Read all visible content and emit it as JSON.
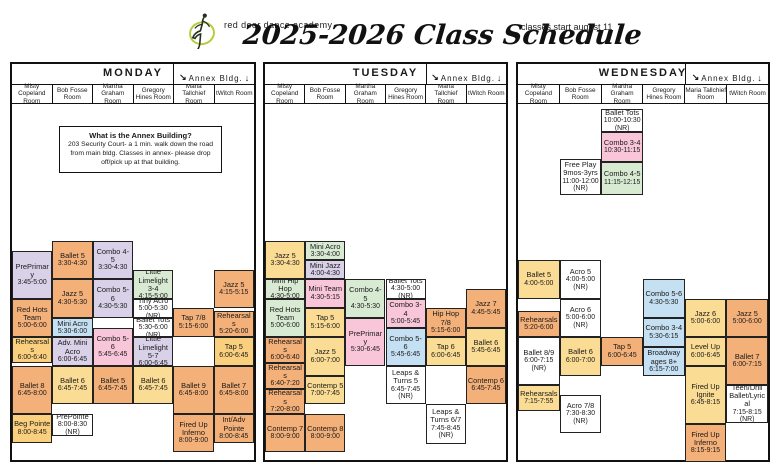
{
  "header": {
    "studio_name": "red door dance academy",
    "title": "2025-2026 Class Schedule",
    "start_note": "classes start august 11"
  },
  "annex": {
    "label": "Annex Bldg.",
    "arrow_left": "↘",
    "arrow_right": "↓"
  },
  "annex_info": {
    "title": "What is the Annex Building?",
    "body": "203 Security Court- a 1 min. walk down the road from main bldg. Classes in annex- please drop off/pick up at that building."
  },
  "rooms": [
    "Misty Copeland Room",
    "Bob Fosse Room",
    "Martha Graham Room",
    "Gregory Hines Room",
    "Maria Tallchief Room",
    "tWitch Room"
  ],
  "colors": {
    "orange": "#F4B079",
    "yellow": "#FBDC94",
    "gold": "#FAD07E",
    "lavender": "#D8D1E8",
    "green": "#D8EAD2",
    "pink": "#F8C6D8",
    "blue": "#C5E0F2",
    "white": "#FFFFFF"
  },
  "days": [
    {
      "name": "MONDAY",
      "classes": [
        {
          "room": 0,
          "name": "PrePrimary",
          "time": "3:45-5:00",
          "color": "lavender",
          "top": 147,
          "h": 48
        },
        {
          "room": 0,
          "name": "Red Hots Team",
          "time": "5:00-6:00",
          "color": "orange",
          "top": 195,
          "h": 38
        },
        {
          "room": 0,
          "name": "Rehearsals",
          "time": "6:00-6:40",
          "color": "gold",
          "top": 233,
          "h": 26
        },
        {
          "room": 0,
          "name": "Ballet 8",
          "time": "6:45-8:00",
          "color": "orange",
          "top": 262,
          "h": 48
        },
        {
          "room": 0,
          "name": "Beg Pointe",
          "time": "8:00-8:45",
          "color": "gold",
          "top": 310,
          "h": 29
        },
        {
          "room": 1,
          "name": "Ballet 5",
          "time": "3:30-4:30",
          "color": "orange",
          "top": 137,
          "h": 38
        },
        {
          "room": 1,
          "name": "Jazz 5",
          "time": "4:30-5:30",
          "color": "orange",
          "top": 175,
          "h": 39
        },
        {
          "room": 1,
          "name": "Mini Acro",
          "time": "5:30-6:00",
          "color": "blue",
          "top": 214,
          "h": 19
        },
        {
          "room": 1,
          "name": "Adv. Mini Acro",
          "time": "6:00-6:45",
          "color": "lavender",
          "top": 233,
          "h": 29
        },
        {
          "room": 1,
          "name": "Ballet 6",
          "time": "6:45-7:45",
          "color": "yellow",
          "top": 262,
          "h": 38
        },
        {
          "room": 1,
          "name": "PrePointe",
          "time": "8:00-8:30 (NR)",
          "color": "white",
          "top": 310,
          "h": 22
        },
        {
          "room": 2,
          "name": "Combo 4-5",
          "time": "3:30-4:30",
          "color": "lavender",
          "top": 137,
          "h": 38
        },
        {
          "room": 2,
          "name": "Combo 5-6",
          "time": "4:30-5:30",
          "color": "lavender",
          "top": 175,
          "h": 39
        },
        {
          "room": 2,
          "name": "Combo 5-6",
          "time": "5:45-6:45",
          "color": "pink",
          "top": 224,
          "h": 38
        },
        {
          "room": 2,
          "name": "Ballet 5",
          "time": "6:45-7:45",
          "color": "orange",
          "top": 262,
          "h": 38
        },
        {
          "room": 3,
          "name": "Little Limelight 3-4",
          "time": "4:15-5:00",
          "color": "green",
          "top": 166,
          "h": 29
        },
        {
          "room": 3,
          "name": "Tiny Acro",
          "time": "5:00-5:30 (NR)",
          "color": "white",
          "top": 195,
          "h": 19
        },
        {
          "room": 3,
          "name": "Ballet Tots",
          "time": "5:30-6:00 (NR)",
          "color": "white",
          "top": 214,
          "h": 19
        },
        {
          "room": 3,
          "name": "Little Limelight 5-7",
          "time": "6:00-6:45",
          "color": "lavender",
          "top": 233,
          "h": 29
        },
        {
          "room": 3,
          "name": "Ballet 6",
          "time": "6:45-7:45",
          "color": "yellow",
          "top": 262,
          "h": 38
        },
        {
          "room": 4,
          "name": "Tap 7/8",
          "time": "5:15-6:00",
          "color": "orange",
          "top": 204,
          "h": 29
        },
        {
          "room": 4,
          "name": "Ballet 9",
          "time": "6:45-8:00",
          "color": "orange",
          "top": 262,
          "h": 48
        },
        {
          "room": 4,
          "name": "Fired Up Inferno",
          "time": "8:00-9:00",
          "color": "orange",
          "top": 310,
          "h": 38
        },
        {
          "room": 5,
          "name": "Jazz 5",
          "time": "4:15-5:15",
          "color": "orange",
          "top": 166,
          "h": 38
        },
        {
          "room": 5,
          "name": "Rehearsals",
          "time": "5:20-6:00",
          "color": "orange",
          "top": 207,
          "h": 26
        },
        {
          "room": 5,
          "name": "Tap 5",
          "time": "6:00-6:45",
          "color": "gold",
          "top": 233,
          "h": 29
        },
        {
          "room": 5,
          "name": "Ballet 7",
          "time": "6:45-8:00",
          "color": "orange",
          "top": 262,
          "h": 48
        },
        {
          "room": 5,
          "name": "Int/Adv Pointe",
          "time": "8:00-8:45",
          "color": "orange",
          "top": 310,
          "h": 29
        }
      ]
    },
    {
      "name": "TUESDAY",
      "classes": [
        {
          "room": 0,
          "name": "Jazz 5",
          "time": "3:30-4:30",
          "color": "yellow",
          "top": 137,
          "h": 38
        },
        {
          "room": 0,
          "name": "Mini Hip Hop",
          "time": "4:30-5:00",
          "color": "green",
          "top": 175,
          "h": 20
        },
        {
          "room": 0,
          "name": "Red Hots Team",
          "time": "5:00-6:00",
          "color": "green",
          "top": 195,
          "h": 38
        },
        {
          "room": 0,
          "name": "Rehearsals",
          "time": "6:00-6:40",
          "color": "orange",
          "top": 233,
          "h": 26
        },
        {
          "room": 0,
          "name": "Rehearsals",
          "time": "6:40-7:20",
          "color": "orange",
          "top": 259,
          "h": 26
        },
        {
          "room": 0,
          "name": "Rehearsals",
          "time": "7:20-8:00",
          "color": "orange",
          "top": 285,
          "h": 25
        },
        {
          "room": 0,
          "name": "Contemp 7",
          "time": "8:00-9:00",
          "color": "orange",
          "top": 310,
          "h": 38
        },
        {
          "room": 1,
          "name": "Mini Acro",
          "time": "3:30-4:00",
          "color": "green",
          "top": 137,
          "h": 19
        },
        {
          "room": 1,
          "name": "Mini Jazz",
          "time": "4:00-4:30",
          "color": "lavender",
          "top": 156,
          "h": 19
        },
        {
          "room": 1,
          "name": "Mini Team",
          "time": "4:30-5:15",
          "color": "pink",
          "top": 175,
          "h": 29
        },
        {
          "room": 1,
          "name": "Tap 5",
          "time": "5:15-6:00",
          "color": "yellow",
          "top": 204,
          "h": 29
        },
        {
          "room": 1,
          "name": "Jazz 5",
          "time": "6:00-7:00",
          "color": "yellow",
          "top": 233,
          "h": 39
        },
        {
          "room": 1,
          "name": "Contemp 5",
          "time": "7:00-7:45",
          "color": "yellow",
          "top": 272,
          "h": 28
        },
        {
          "room": 1,
          "name": "Contemp 8",
          "time": "8:00-9:00",
          "color": "orange",
          "top": 310,
          "h": 38
        },
        {
          "room": 2,
          "name": "Combo 4-5",
          "time": "4:30-5:30",
          "color": "green",
          "top": 175,
          "h": 39
        },
        {
          "room": 2,
          "name": "PrePrimary",
          "time": "5:30-6:45",
          "color": "pink",
          "top": 214,
          "h": 48
        },
        {
          "room": 3,
          "name": "Ballet Tots",
          "time": "4:30-5:00 (NR)",
          "color": "white",
          "top": 175,
          "h": 20
        },
        {
          "room": 3,
          "name": "Combo 3-4",
          "time": "5:00-5:45",
          "color": "pink",
          "top": 195,
          "h": 29
        },
        {
          "room": 3,
          "name": "Combo 5-6",
          "time": "5:45-6:45",
          "color": "blue",
          "top": 224,
          "h": 38
        },
        {
          "room": 3,
          "name": "Leaps & Turns 5",
          "time": "6:45-7:45 (NR)",
          "color": "white",
          "top": 262,
          "h": 38
        },
        {
          "room": 4,
          "name": "Hip Hop 7/8",
          "time": "5:15-6:00",
          "color": "orange",
          "top": 204,
          "h": 29
        },
        {
          "room": 4,
          "name": "Tap 6",
          "time": "6:00-6:45",
          "color": "yellow",
          "top": 233,
          "h": 29
        },
        {
          "room": 4,
          "name": "Leaps & Turns 6/7",
          "time": "7:45-8:45 (NR)",
          "color": "white",
          "top": 300,
          "h": 40
        },
        {
          "room": 5,
          "name": "Jazz 7",
          "time": "4:45-5:45",
          "color": "orange",
          "top": 185,
          "h": 39
        },
        {
          "room": 5,
          "name": "Ballet 6",
          "time": "5:45-6:45",
          "color": "yellow",
          "top": 224,
          "h": 38
        },
        {
          "room": 5,
          "name": "Contemp 6",
          "time": "6:45-7:45",
          "color": "orange",
          "top": 262,
          "h": 38
        }
      ]
    },
    {
      "name": "WEDNESDAY",
      "classes": [
        {
          "room": 0,
          "name": "Ballet 5",
          "time": "4:00-5:00",
          "color": "yellow",
          "top": 156,
          "h": 39
        },
        {
          "room": 0,
          "name": "Rehearsals",
          "time": "5:20-6:00",
          "color": "orange",
          "top": 207,
          "h": 26
        },
        {
          "room": 0,
          "name": "Ballet 8/9",
          "time": "6:00-7:15 (NR)",
          "color": "white",
          "top": 233,
          "h": 48
        },
        {
          "room": 0,
          "name": "Rehearsals",
          "time": "7:15-7:55",
          "color": "yellow",
          "top": 281,
          "h": 26
        },
        {
          "room": 1,
          "name": "Free Play 9mos-3yrs",
          "time": "11:00-12:00 (NR)",
          "color": "white",
          "top": 55,
          "h": 36
        },
        {
          "room": 1,
          "name": "Acro 5",
          "time": "4:00-5:00 (NR)",
          "color": "white",
          "top": 156,
          "h": 39
        },
        {
          "room": 1,
          "name": "Acro 6",
          "time": "5:00-6:00 (NR)",
          "color": "white",
          "top": 195,
          "h": 38
        },
        {
          "room": 1,
          "name": "Ballet 6",
          "time": "6:00-7:00",
          "color": "yellow",
          "top": 233,
          "h": 39
        },
        {
          "room": 1,
          "name": "Acro 7/8",
          "time": "7:30-8:30 (NR)",
          "color": "white",
          "top": 291,
          "h": 38
        },
        {
          "room": 2,
          "name": "Ballet Tots",
          "time": "10:00-10:30 (NR)",
          "color": "white",
          "top": 5,
          "h": 23
        },
        {
          "room": 2,
          "name": "Combo 3-4",
          "time": "10:30-11:15",
          "color": "pink",
          "top": 28,
          "h": 30
        },
        {
          "room": 2,
          "name": "Combo 4-5",
          "time": "11:15-12:15",
          "color": "green",
          "top": 58,
          "h": 33
        },
        {
          "room": 2,
          "name": "Tap 5",
          "time": "6:00-6:45",
          "color": "orange",
          "top": 233,
          "h": 29
        },
        {
          "room": 3,
          "name": "Combo 5-6",
          "time": "4:30-5:30",
          "color": "blue",
          "top": 175,
          "h": 39
        },
        {
          "room": 3,
          "name": "Combo 3-4",
          "time": "5:30-6:15",
          "color": "blue",
          "top": 214,
          "h": 29
        },
        {
          "room": 3,
          "name": "Broadway ages 8+",
          "time": "6:15-7:00",
          "color": "blue",
          "top": 243,
          "h": 29
        },
        {
          "room": 4,
          "name": "Jazz 6",
          "time": "5:00-6:00",
          "color": "yellow",
          "top": 195,
          "h": 38
        },
        {
          "room": 4,
          "name": "Level Up",
          "time": "6:00-6:45",
          "color": "yellow",
          "top": 233,
          "h": 29
        },
        {
          "room": 4,
          "name": "Fired Up Ignite",
          "time": "6:45-8:15",
          "color": "yellow",
          "top": 262,
          "h": 58
        },
        {
          "room": 4,
          "name": "Fired Up Inferno",
          "time": "8:15-9:15",
          "color": "orange",
          "top": 320,
          "h": 38
        },
        {
          "room": 5,
          "name": "Jazz 5",
          "time": "5:00-6:00",
          "color": "orange",
          "top": 195,
          "h": 38
        },
        {
          "room": 5,
          "name": "Ballet 7",
          "time": "6:00-7:15",
          "color": "orange",
          "top": 233,
          "h": 48
        },
        {
          "room": 5,
          "name": "Teen/Drill Ballet/Lyrical",
          "time": "7:15-8:15 (NR)",
          "color": "white",
          "top": 281,
          "h": 38
        }
      ]
    }
  ]
}
